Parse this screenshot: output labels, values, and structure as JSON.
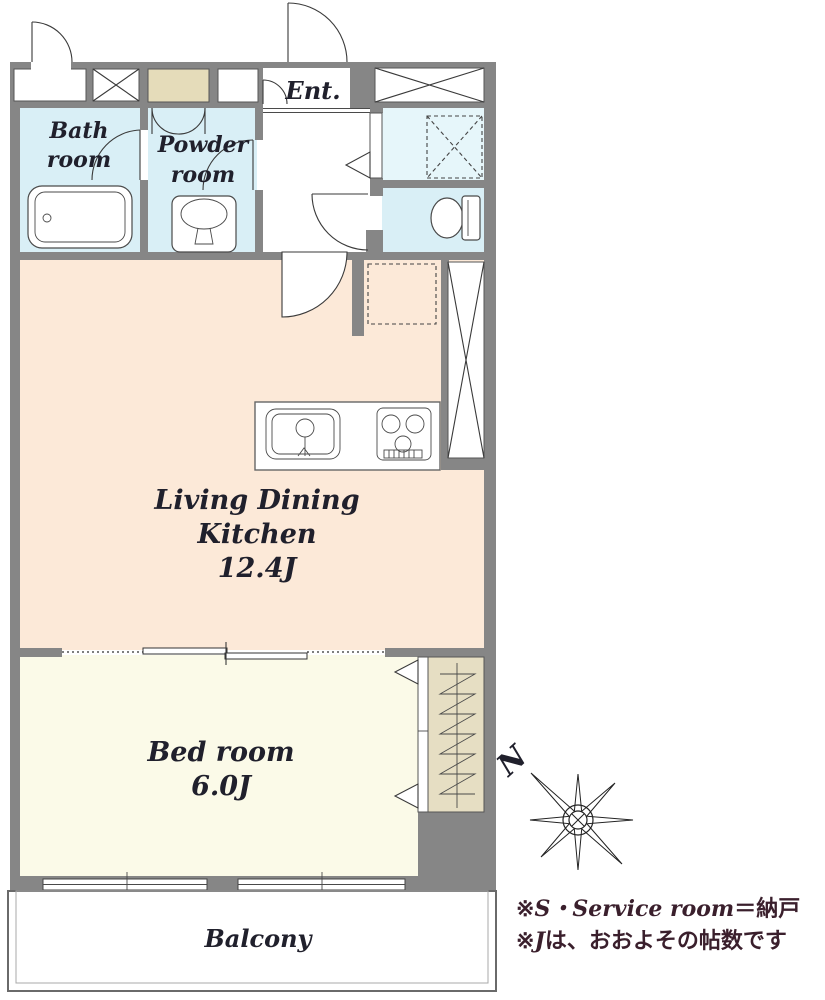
{
  "rooms": {
    "bath": {
      "line1": "Bath",
      "line2": "room"
    },
    "powder": {
      "line1": "Powder",
      "line2": "room"
    },
    "entrance": {
      "label": "Ent."
    },
    "ldk": {
      "line1": "Living Dining",
      "line2": "Kitchen",
      "size": "12.4J"
    },
    "bedroom": {
      "line1": "Bed room",
      "size": "6.0J"
    },
    "balcony": {
      "label": "Balcony"
    }
  },
  "compass": {
    "north_label": "N"
  },
  "notes": {
    "line1_mark": "※",
    "line1_latin": "S・Service room",
    "line1_rest": "＝納戸",
    "line2_mark": "※",
    "line2_latin": "J",
    "line2_rest": "は、おおよその帖数です"
  },
  "colors": {
    "wall": "#868686",
    "ldk_floor": "#fce9d8",
    "bedroom_floor": "#fbfae8",
    "wet_floor": "#d9eff6",
    "wet_floor_light": "#e6f6fa",
    "meter_box": "#e5dcba",
    "closet": "#e6dec3",
    "label_text": "#20202c",
    "note_text": "#3a1f2c"
  }
}
